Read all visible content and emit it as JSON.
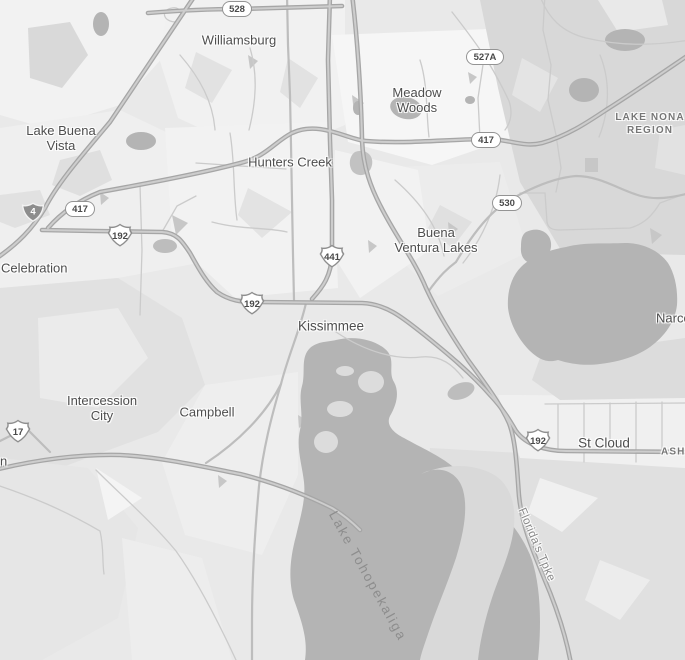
{
  "map": {
    "type": "grayscale-road-map",
    "area": "Kissimmee / St Cloud, Florida",
    "colors": {
      "background": "#e9e9e9",
      "water": "#b4b4b4",
      "town_text": "#4e4e4e",
      "highway": "#a6a6a6"
    },
    "labels": {
      "towns": [
        {
          "id": "williamsburg",
          "lines": [
            "Williamsburg"
          ],
          "x": 239,
          "y": 40,
          "anchor": "center"
        },
        {
          "id": "meadow-woods",
          "lines": [
            "Meadow",
            "Woods"
          ],
          "x": 417,
          "y": 100,
          "anchor": "center"
        },
        {
          "id": "lake-buena-vista",
          "lines": [
            "Lake Buena",
            "Vista"
          ],
          "x": 61,
          "y": 138,
          "anchor": "center"
        },
        {
          "id": "hunters-creek",
          "lines": [
            "Hunters Creek"
          ],
          "x": 290,
          "y": 162,
          "anchor": "center"
        },
        {
          "id": "buena-ventura-lakes",
          "lines": [
            "Buena",
            "Ventura Lakes"
          ],
          "x": 436,
          "y": 240,
          "anchor": "center"
        },
        {
          "id": "celebration",
          "lines": [
            "Celebration"
          ],
          "x": 1,
          "y": 268,
          "anchor": "left"
        },
        {
          "id": "kissimmee",
          "lines": [
            "Kissimmee"
          ],
          "x": 331,
          "y": 326,
          "anchor": "center",
          "large": true
        },
        {
          "id": "intercession-city",
          "lines": [
            "Intercession",
            "City"
          ],
          "x": 102,
          "y": 408,
          "anchor": "center"
        },
        {
          "id": "campbell",
          "lines": [
            "Campbell"
          ],
          "x": 207,
          "y": 412,
          "anchor": "center"
        },
        {
          "id": "st-cloud",
          "lines": [
            "St Cloud"
          ],
          "x": 604,
          "y": 443,
          "anchor": "center",
          "large": true
        },
        {
          "id": "narcoossee",
          "lines": [
            "Narcoossee"
          ],
          "x": 656,
          "y": 318,
          "anchor": "left"
        },
        {
          "id": "edge-partial-n",
          "lines": [
            "n"
          ],
          "x": 0,
          "y": 461,
          "anchor": "left"
        }
      ],
      "regions": [
        {
          "id": "lake-nona-region",
          "lines": [
            "LAKE NONA",
            "REGION"
          ],
          "x": 650,
          "y": 124,
          "anchor": "center"
        },
        {
          "id": "ashton",
          "lines": [
            "ASHTON"
          ],
          "x": 661,
          "y": 452,
          "anchor": "left"
        }
      ],
      "water": [
        {
          "id": "lake-tohopekaliga",
          "text": "Lake Tohopekaliga",
          "x": 368,
          "y": 576,
          "rotate": 61
        }
      ],
      "roads": [
        {
          "id": "floridas-tpke",
          "text": "Florida's Tpke",
          "x": 536,
          "y": 545,
          "rotate": 67
        }
      ]
    },
    "shields": {
      "toll": [
        {
          "text": "528",
          "x": 237,
          "y": 9
        },
        {
          "text": "527A",
          "x": 485,
          "y": 57
        },
        {
          "text": "417",
          "x": 80,
          "y": 209
        },
        {
          "text": "417",
          "x": 486,
          "y": 140
        },
        {
          "text": "530",
          "x": 507,
          "y": 203
        }
      ],
      "us_route": [
        {
          "text": "192",
          "x": 120,
          "y": 235
        },
        {
          "text": "441",
          "x": 332,
          "y": 256
        },
        {
          "text": "192",
          "x": 252,
          "y": 303
        },
        {
          "text": "192",
          "x": 538,
          "y": 440
        },
        {
          "text": "17",
          "x": 18,
          "y": 431
        }
      ],
      "interstate": [
        {
          "text": "4",
          "x": 33,
          "y": 212
        }
      ]
    }
  }
}
